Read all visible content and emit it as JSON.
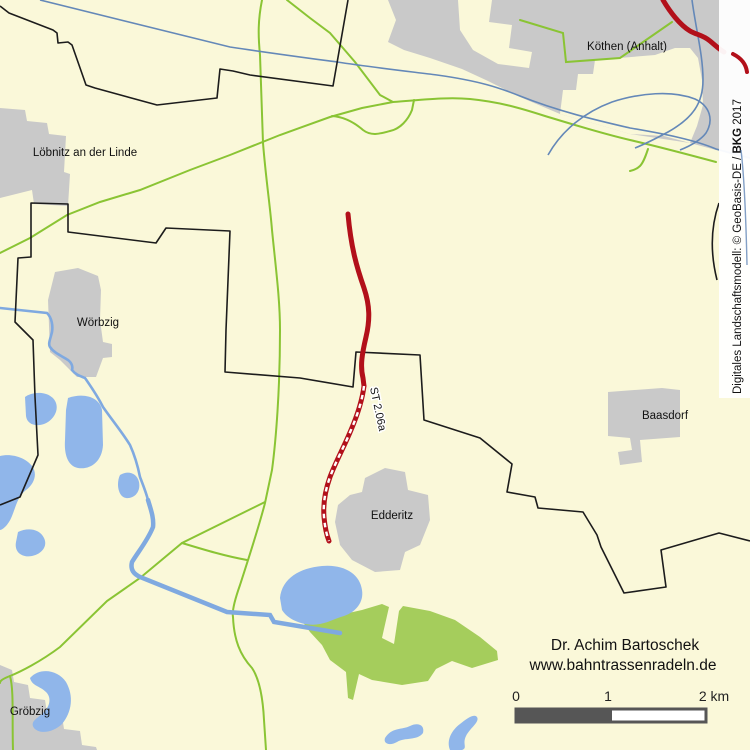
{
  "map": {
    "towns": [
      {
        "name": "Köthen (Anhalt)"
      },
      {
        "name": "Löbnitz an der Linde"
      },
      {
        "name": "Wörbzig"
      },
      {
        "name": "Baasdorf"
      },
      {
        "name": "Edderitz"
      },
      {
        "name": "Gröbzig"
      }
    ],
    "route": {
      "label": "ST 2.06a",
      "color": "#B2101A"
    },
    "credit": {
      "line1": "Dr. Achim Bartoschek",
      "line2": "www.bahntrassenradeln.de"
    },
    "attribution": {
      "prefix": "Digitales Landschaftsmodell: © GeoBasis-DE / ",
      "bold": "BKG",
      "suffix": " 2017"
    },
    "scale_bar": {
      "label_0": "0",
      "label_1": "1",
      "label_2": "2 km"
    },
    "colors": {
      "background": "#FAF8D9",
      "urban_area": "#C9C9C9",
      "forest": "#A5CD5C",
      "lake": "#90B6EA",
      "river": "#7FA9E0",
      "road_green": "#8AC434",
      "line_blue": "#6488B8",
      "boundary": "#1C1C1C",
      "trail_red": "#B2101A",
      "scalebar": "#565656"
    }
  }
}
